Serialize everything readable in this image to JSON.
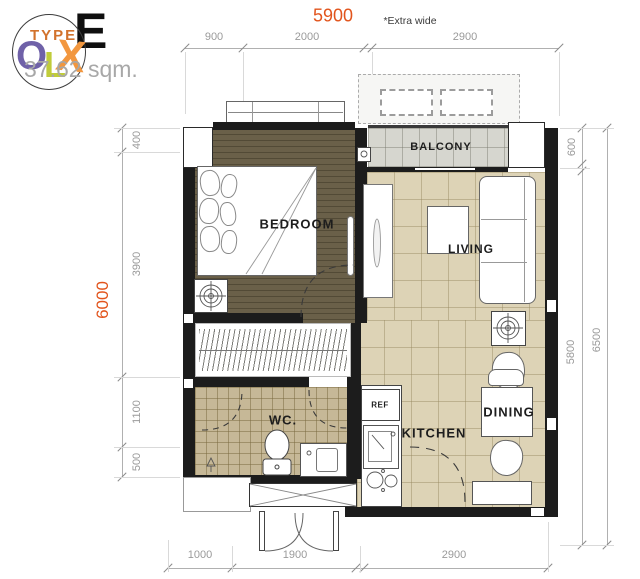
{
  "logo": {
    "type_label": "TYPE",
    "unit_type": "E",
    "area": "37.62 sqm.",
    "olx_o": "O",
    "olx_l": "L",
    "olx_x": "X"
  },
  "dims": {
    "top": {
      "total": "5900",
      "note": "*Extra wide",
      "seg1": "900",
      "seg2": "2000",
      "seg3": "2900"
    },
    "bottom": {
      "seg1": "1000",
      "seg2": "1900",
      "seg3": "2900"
    },
    "left": {
      "total": "6000",
      "seg1": "400",
      "seg2": "3900",
      "seg3": "1100",
      "seg4": "500"
    },
    "right": {
      "seg1": "600",
      "seg2": "5800",
      "total": "6500"
    }
  },
  "rooms": {
    "bedroom": "BEDROOM",
    "balcony": "BALCONY",
    "living": "LIVING",
    "wc": "WC.",
    "kitchen": "KITCHEN",
    "dining": "DINING",
    "refrigerator": "REF"
  },
  "colors": {
    "accent_orange": "#e2541c",
    "dim_gray": "#9a9a9a",
    "wall_black": "#1c1c1c",
    "bedroom_floor": "#6a6049",
    "tile_beige": "#ddd3b6",
    "tile_wc": "#c6b897",
    "tile_balcony": "#d6d6cf",
    "logo_purple": "#6f61a8",
    "logo_lime": "#c0cc3a",
    "logo_orange": "#f2973f"
  }
}
